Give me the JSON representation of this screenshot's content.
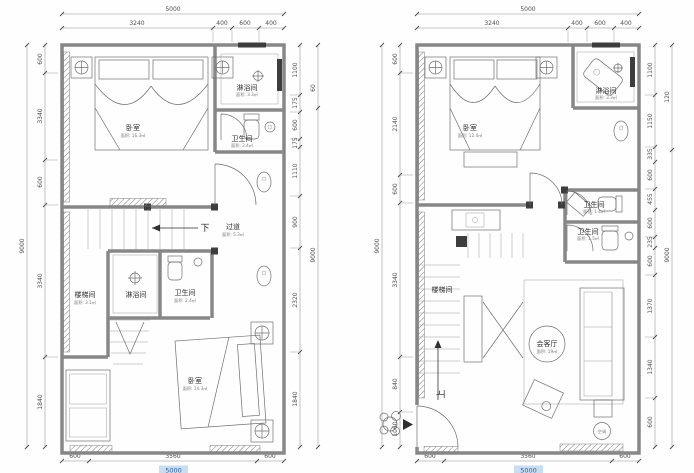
{
  "drawing": {
    "type": "architectural floor plan, two storeys",
    "colors": {
      "wall": "#878787",
      "line": "#6f6f6f",
      "dim_text": "#4f4f4f",
      "highlight": "#c9ddf2"
    }
  },
  "plan_left": {
    "dims": {
      "top_total": "5000",
      "top": [
        "3240",
        "400",
        "600",
        "400"
      ],
      "left_total": "9000",
      "left": [
        "600",
        "3340",
        "600",
        "3340",
        "1840"
      ],
      "right": [
        "1100",
        "175",
        "600",
        "175",
        "1110",
        "900",
        "2320",
        "1840"
      ],
      "right_outer_top": "60",
      "right_total": "9000",
      "bottom": [
        "600",
        "3560",
        "600"
      ],
      "bottom_total": "5000"
    },
    "rooms": {
      "bedroom_top": {
        "name": "卧室",
        "area": "面积: 16.3㎡"
      },
      "shower_top": {
        "name": "淋浴间",
        "area": "面积: 3.3㎡"
      },
      "bath_top": {
        "name": "卫生间",
        "area": "面积: 2.4㎡"
      },
      "corridor": {
        "name": "过道",
        "area": "面积: 5.3㎡"
      },
      "stairwell": {
        "name": "楼梯间",
        "area": "面积: 3.1㎡"
      },
      "shower_mid": {
        "name": "淋浴间",
        "area": ""
      },
      "bath_mid": {
        "name": "卫生间",
        "area": "面积: 2.4㎡"
      },
      "bedroom_bottom": {
        "name": "卧室",
        "area": "面积: 14.3㎡"
      }
    },
    "annotations": {
      "down": "下"
    }
  },
  "plan_right": {
    "dims": {
      "top_total": "5000",
      "top": [
        "3240",
        "400",
        "600",
        "400"
      ],
      "left_total": "9000",
      "left": [
        "600",
        "2140",
        "600",
        "3340",
        "840",
        "1060"
      ],
      "right": [
        "1100",
        "1150",
        "335",
        "600",
        "455",
        "600",
        "235",
        "600",
        "1370",
        "1340",
        "600"
      ],
      "right_outer_top": "120",
      "right_total": "9000",
      "bottom": [
        "600",
        "3560",
        "600"
      ],
      "bottom_total": "5000"
    },
    "rooms": {
      "bedroom": {
        "name": "卧室",
        "area": "面积: 12.4㎡"
      },
      "shower": {
        "name": "淋浴间",
        "area": "面积: 3.3㎡"
      },
      "bath_1": {
        "name": "卫生间",
        "area": "面积: 1.4㎡"
      },
      "bath_2": {
        "name": "卫生间",
        "area": "面积: 1.5㎡"
      },
      "stairwell": {
        "name": "楼梯间",
        "area": ""
      },
      "living": {
        "name": "会客厅",
        "area": "面积: 19㎡"
      },
      "ac_unit": {
        "name": "空调"
      }
    },
    "annotations": {
      "up": "上"
    }
  }
}
